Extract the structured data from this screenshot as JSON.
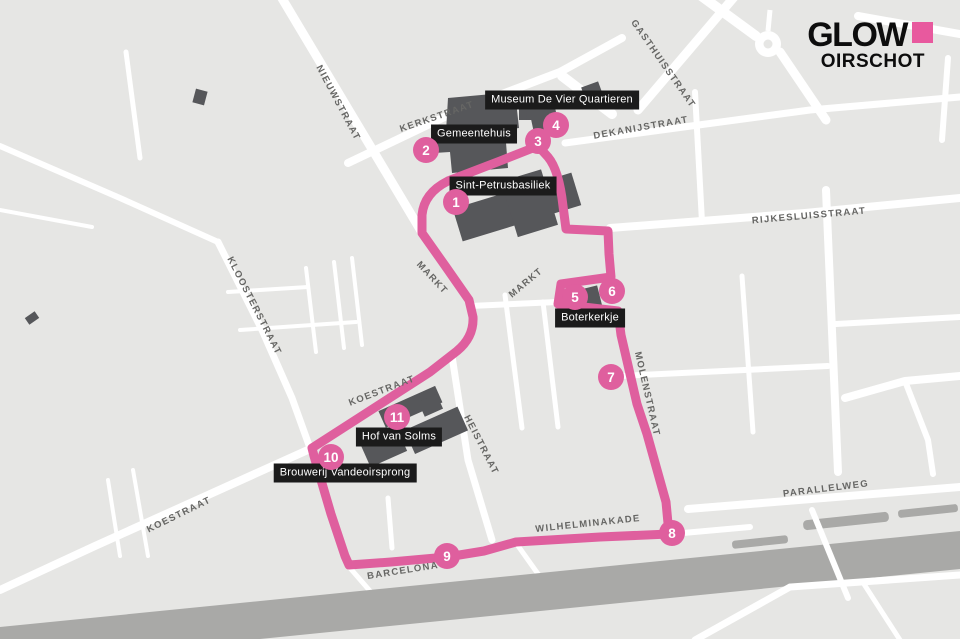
{
  "logo": {
    "title": "GLOW",
    "subtitle": "OIRSCHOT",
    "square_color": "#e8599e"
  },
  "colors": {
    "background": "#e6e6e4",
    "street": "#ffffff",
    "building": "#56575a",
    "canal": "#a9a9a7",
    "route": "#df5f9e",
    "poi_label_bg": "#1b1b1b",
    "poi_label_text": "#ffffff",
    "street_label_text": "#666664"
  },
  "street_labels": [
    {
      "label": "NIEUWSTRAAT",
      "x": 338,
      "y": 103,
      "rot": 62
    },
    {
      "label": "KERKSTRAAT",
      "x": 437,
      "y": 117,
      "rot": -19
    },
    {
      "label": "GASTHUISSTRAAT",
      "x": 663,
      "y": 64,
      "rot": 55
    },
    {
      "label": "DEKANIJSTRAAT",
      "x": 641,
      "y": 128,
      "rot": -10
    },
    {
      "label": "RIJKESLUISSTRAAT",
      "x": 809,
      "y": 216,
      "rot": -5
    },
    {
      "label": "KLOOSTERSTRAAT",
      "x": 254,
      "y": 306,
      "rot": 63
    },
    {
      "label": "MARKT",
      "x": 432,
      "y": 278,
      "rot": 47
    },
    {
      "label": "MARKT",
      "x": 526,
      "y": 283,
      "rot": -40
    },
    {
      "label": "KOESTRAAT",
      "x": 382,
      "y": 391,
      "rot": -21
    },
    {
      "label": "HEISTRAAT",
      "x": 481,
      "y": 445,
      "rot": 63
    },
    {
      "label": "MOLENSTRAAT",
      "x": 647,
      "y": 394,
      "rot": 77
    },
    {
      "label": "KOESTRAAT",
      "x": 179,
      "y": 515,
      "rot": -26
    },
    {
      "label": "PARALLELWEG",
      "x": 826,
      "y": 489,
      "rot": -7
    },
    {
      "label": "WILHELMINAKADE",
      "x": 588,
      "y": 524,
      "rot": -6
    },
    {
      "label": "BARCELONA",
      "x": 403,
      "y": 571,
      "rot": -9
    }
  ],
  "poi_labels": [
    {
      "label": "Museum De Vier Quartieren",
      "x": 562,
      "y": 100
    },
    {
      "label": "Gemeentehuis",
      "x": 474,
      "y": 134
    },
    {
      "label": "Sint-Petrusbasiliek",
      "x": 503,
      "y": 186
    },
    {
      "label": "Boterkerkje",
      "x": 590,
      "y": 318
    },
    {
      "label": "Hof van Solms",
      "x": 399,
      "y": 437
    },
    {
      "label": "Brouwerij Vandeoirsprong",
      "x": 345,
      "y": 473
    }
  ],
  "stops": [
    {
      "number": "1",
      "x": 456,
      "y": 202
    },
    {
      "number": "2",
      "x": 426,
      "y": 150
    },
    {
      "number": "3",
      "x": 538,
      "y": 141
    },
    {
      "number": "4",
      "x": 556,
      "y": 125
    },
    {
      "number": "5",
      "x": 575,
      "y": 297
    },
    {
      "number": "6",
      "x": 612,
      "y": 291
    },
    {
      "number": "7",
      "x": 611,
      "y": 377
    },
    {
      "number": "8",
      "x": 672,
      "y": 533
    },
    {
      "number": "9",
      "x": 447,
      "y": 556
    },
    {
      "number": "10",
      "x": 331,
      "y": 457
    },
    {
      "number": "11",
      "x": 397,
      "y": 417
    }
  ]
}
